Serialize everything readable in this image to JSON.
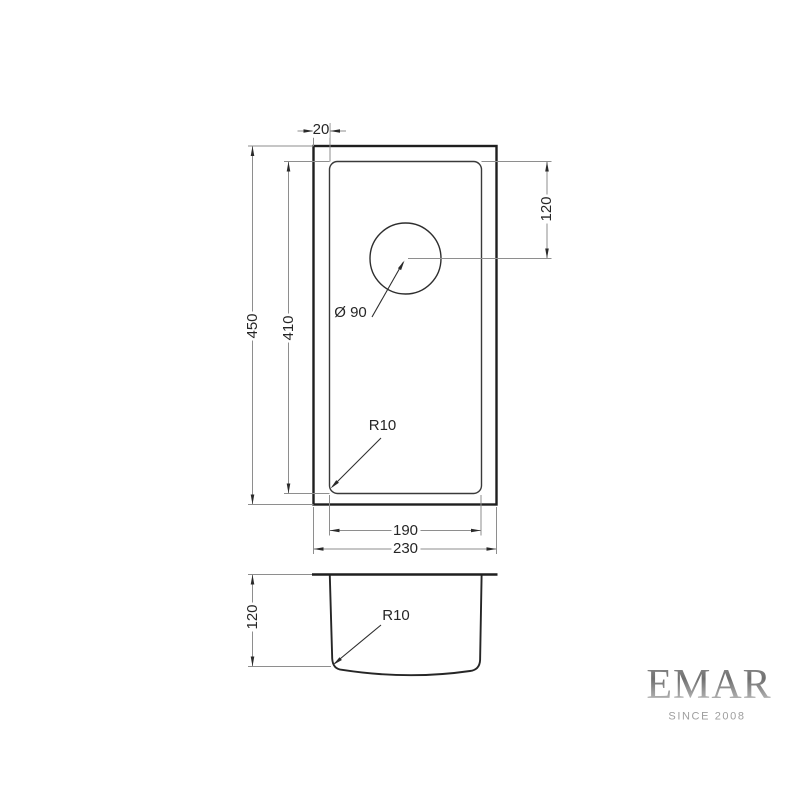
{
  "dims": {
    "top_flange": "20",
    "overall_length": "450",
    "bowl_length": "410",
    "drain_offset": "120",
    "drain_diameter": "Ø 90",
    "top_corner_radius": "R10",
    "bowl_width": "190",
    "overall_width": "230",
    "depth": "120",
    "side_corner_radius": "R10"
  },
  "logo": {
    "brand": "EMAR",
    "tagline": "SINCE 2008"
  },
  "colors": {
    "object_line": "#1f1f1f",
    "inner_line": "#3a3a3a",
    "dim_line": "#8e8e8e",
    "arrow": "#2a2a2a",
    "text": "#262626",
    "background": "#ffffff",
    "logo_silver_dark": "#707070",
    "logo_silver_light": "#c9c9c9",
    "tagline_gray": "#9e9e9e"
  }
}
